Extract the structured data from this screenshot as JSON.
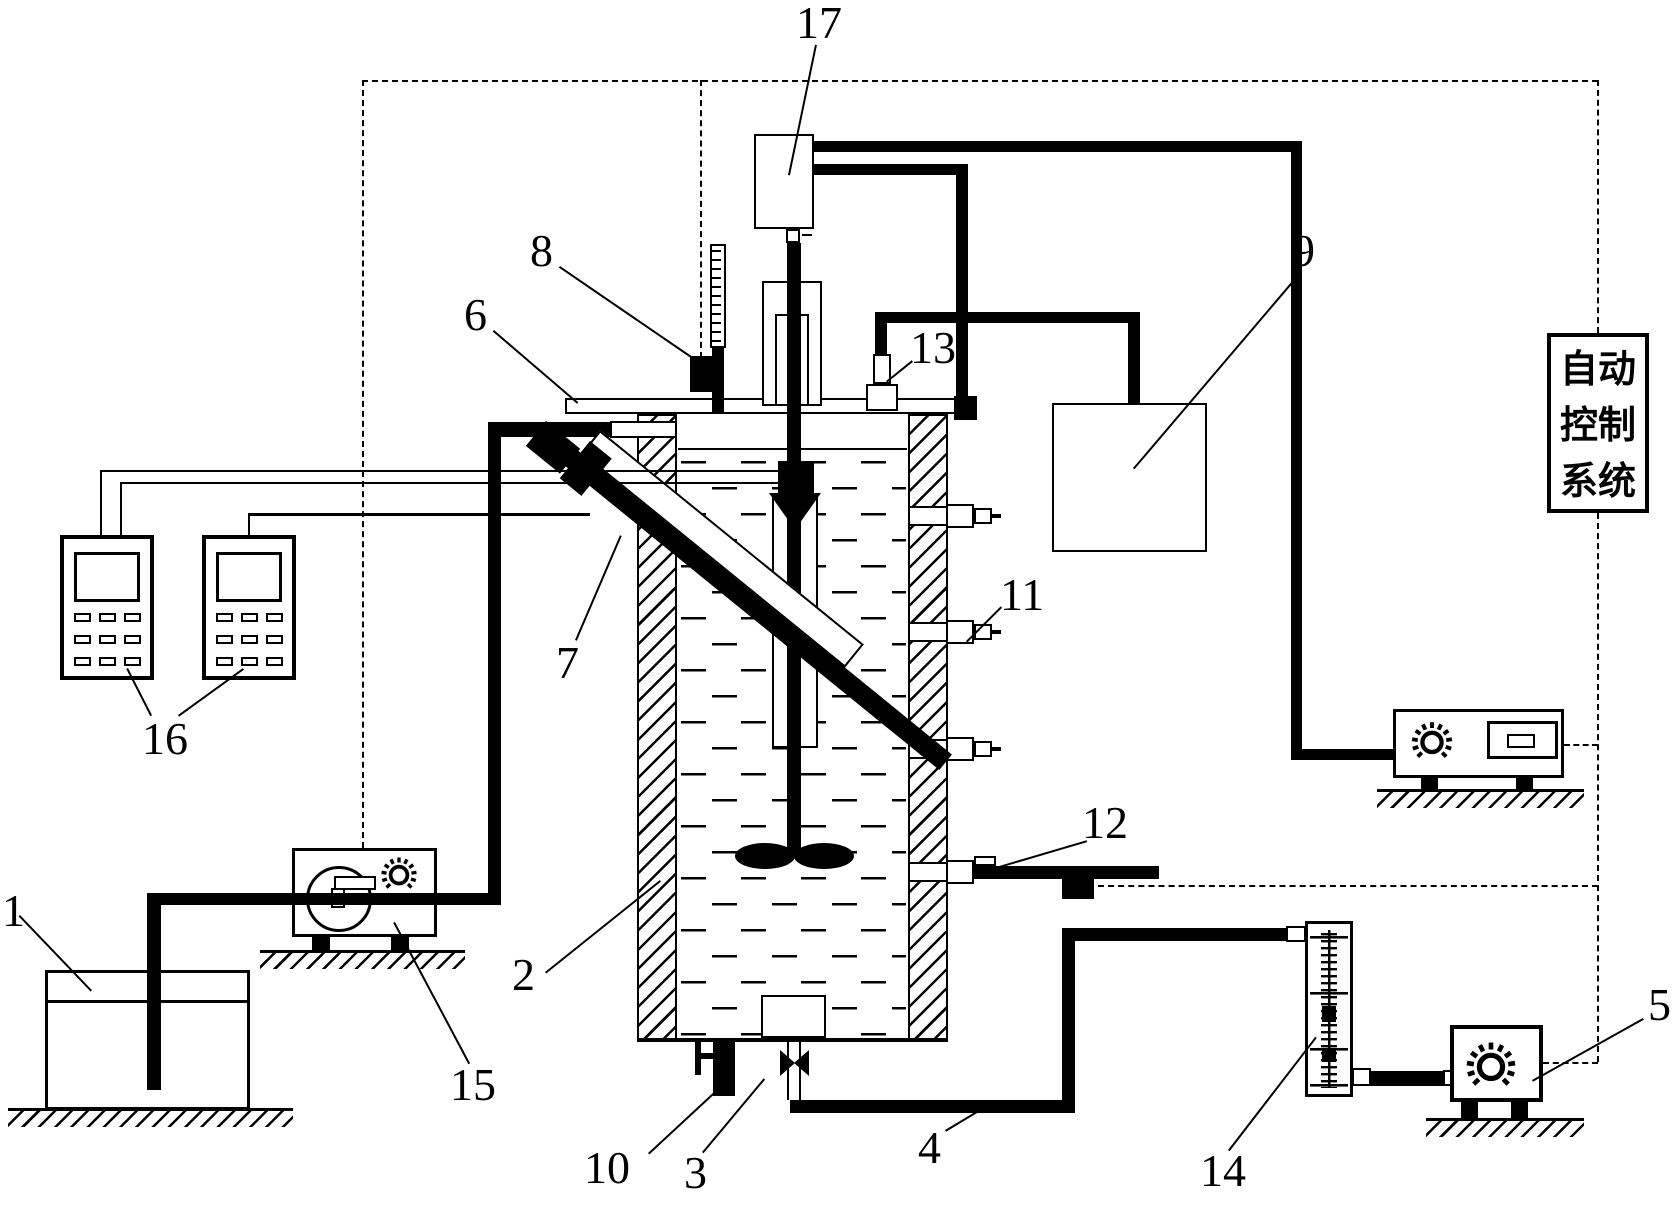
{
  "labels": {
    "n1": "1",
    "n2": "2",
    "n3": "3",
    "n4": "4",
    "n5": "5",
    "n6": "6",
    "n7": "7",
    "n8": "8",
    "n9": "9",
    "n10": "10",
    "n11": "11",
    "n12": "12",
    "n13": "13",
    "n14": "14",
    "n15": "15",
    "n16": "16",
    "n17": "17"
  },
  "control_box": {
    "line1": "自动",
    "line2": "控制",
    "line3": "系统"
  },
  "colors": {
    "ink": "#000000",
    "paper": "#ffffff"
  }
}
